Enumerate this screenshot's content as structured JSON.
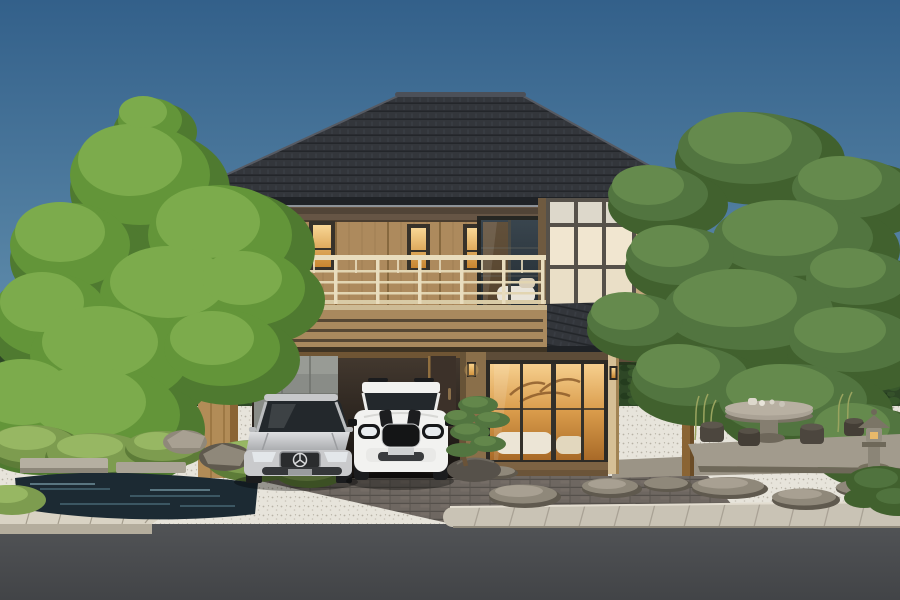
{
  "scene": {
    "description": "Photorealistic 3D architectural rendering of a modern Japanese-style two-story house with dark hipped tile roof, tan wood siding, cream shoji grid panels, a balcony with light railing, a carport holding a silver sedan and a white compact SUV with black stripes, flanked by sculpted pine trees, a zen garden with moss mounds, pond, white gravel, stone tea table with stools, a stone lantern, stepping stones, paver driveway, sidewalk and asphalt road in the foreground under a clear blue sky",
    "objects": {
      "house": {
        "floors": 2,
        "roof": "hipped-dark-tile",
        "upper_narrow_windows": 3,
        "balcony_glass_door": 1,
        "shoji_grid": "3x3-plus-transom",
        "carport_bays": 2,
        "porch_posts": 2,
        "wall_lanterns": 3
      },
      "vehicles": [
        {
          "kind": "sedan",
          "color": "silver",
          "badge": "three-pointed-star"
        },
        {
          "kind": "compact-suv",
          "color": "white",
          "accents": "black hood stripes, black grille, roof rails"
        }
      ],
      "garden_left": [
        "large-pine-tree",
        "moss-mounds",
        "rocks",
        "pond",
        "stone-slab-bridge",
        "white-gravel",
        "hedge"
      ],
      "garden_right": [
        "large-pine-tree",
        "stone-platform",
        "stone-tea-table",
        "tea-set",
        "stone-stools",
        "stone-lantern",
        "wild-grass",
        "stepping-stones",
        "white-gravel",
        "hedge"
      ],
      "foreground": [
        "paver-driveway",
        "curb",
        "sidewalk",
        "asphalt-road",
        "bonsai-pine",
        "rock"
      ]
    },
    "colors": {
      "sky_top": "#33608a",
      "sky_mid": "#5f8cab",
      "sky_horizon": "#a9c7d4",
      "roof_dark": "#33363b",
      "roof_line": "#23262a",
      "roof_highlight": "#565a62",
      "eaves_dark": "#1f2226",
      "gutter_light": "#8d9298",
      "wall_siding": "#ad8a5d",
      "wall_band": "#665545",
      "batten": "#97774e",
      "fascia": "#a9895e",
      "fascia_groove": "#564734",
      "fascia_light": "#cdbb95",
      "balcony_rail": "#e9ddbe",
      "window_frame": "#37322a",
      "warm_top": "#f9d795",
      "warm_bottom": "#c8852f",
      "living_top": "#f6cf8e",
      "living_mid": "#d99b4a",
      "living_bottom": "#a96a28",
      "shoji_panel": "#f1e6d0",
      "shoji_frame": "#56514a",
      "glass_cool_top": "#39454e",
      "glass_cool_bottom": "#232b31",
      "gray_panel": "#898c87",
      "carport_top": "#453a30",
      "carport_bottom": "#151210",
      "pillar_wood": "#b28c57",
      "concrete_gray": "#9ca1a4",
      "downpipe_blue": "#5e7488",
      "hedge_green": "#2e4726",
      "tree_light": "#7cab4c",
      "tree_mid": "#639539",
      "tree_dark": "#4f7a30",
      "pine_light": "#658a4d",
      "pine_mid": "#527540",
      "pine_dark": "#41612e",
      "trunk_brown": "#5d4a33",
      "pine_trunk": "#6e5a3d",
      "moss_green": "#7d9c4f",
      "moss_light": "#97b763",
      "moss_dark": "#5d7c38",
      "gravel_white": "#e7e4db",
      "gravel_dot": "#b7b2a6",
      "stone_gray": "#8f887a",
      "stone_light": "#a8a092",
      "stone_dark": "#5f594e",
      "water_dark": "#1c2a33",
      "water_reflect": "#44636f",
      "paver": "#6e6761",
      "paver_joint": "#55504b",
      "sidewalk": "#c9c3b5",
      "sidewalk_joint": "#a9a295",
      "curb": "#d9d3c4",
      "curb_face": "#b4ad9d",
      "road_top": "#515356",
      "road_bottom": "#424447",
      "car_silver": "#c9cacc",
      "car_silver_dark": "#a6a8ab",
      "car_glass": "#23282c",
      "car_white": "#f2f2f0",
      "car_black": "#1b1c1e",
      "lamp_warm": "#f5c36a",
      "deck_wood": "#7d6343",
      "porch_stone": "#9b9486",
      "door_wood": "#3c3129"
    }
  }
}
